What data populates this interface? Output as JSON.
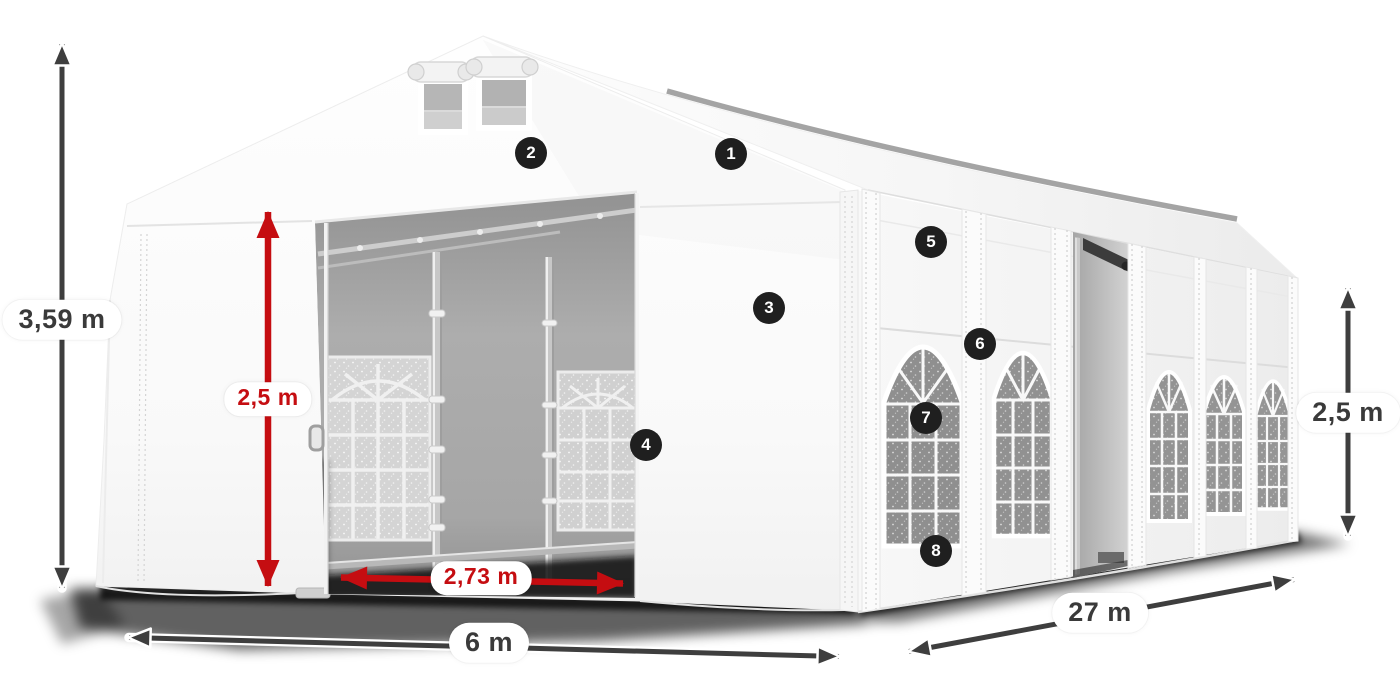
{
  "diagram": {
    "subject": "storage-tent-dimension-diagram",
    "background": "#ffffff"
  },
  "dimensions": {
    "total_height": "3,59 m",
    "inner_door_height": "2,5 m",
    "inner_door_width": "2,73 m",
    "width": "6 m",
    "length": "27 m",
    "side_height": "2,5 m"
  },
  "callouts": [
    {
      "number": "1"
    },
    {
      "number": "2"
    },
    {
      "number": "3"
    },
    {
      "number": "4"
    },
    {
      "number": "5"
    },
    {
      "number": "6"
    },
    {
      "number": "7"
    },
    {
      "number": "8"
    }
  ],
  "colors": {
    "dimension_red": "#c50d11",
    "dimension_gray": "#3e3e3e",
    "badge_background": "#1f1f1f",
    "badge_text": "#ffffff",
    "label_background": "#ffffff",
    "label_text": "#3a3a3a"
  }
}
